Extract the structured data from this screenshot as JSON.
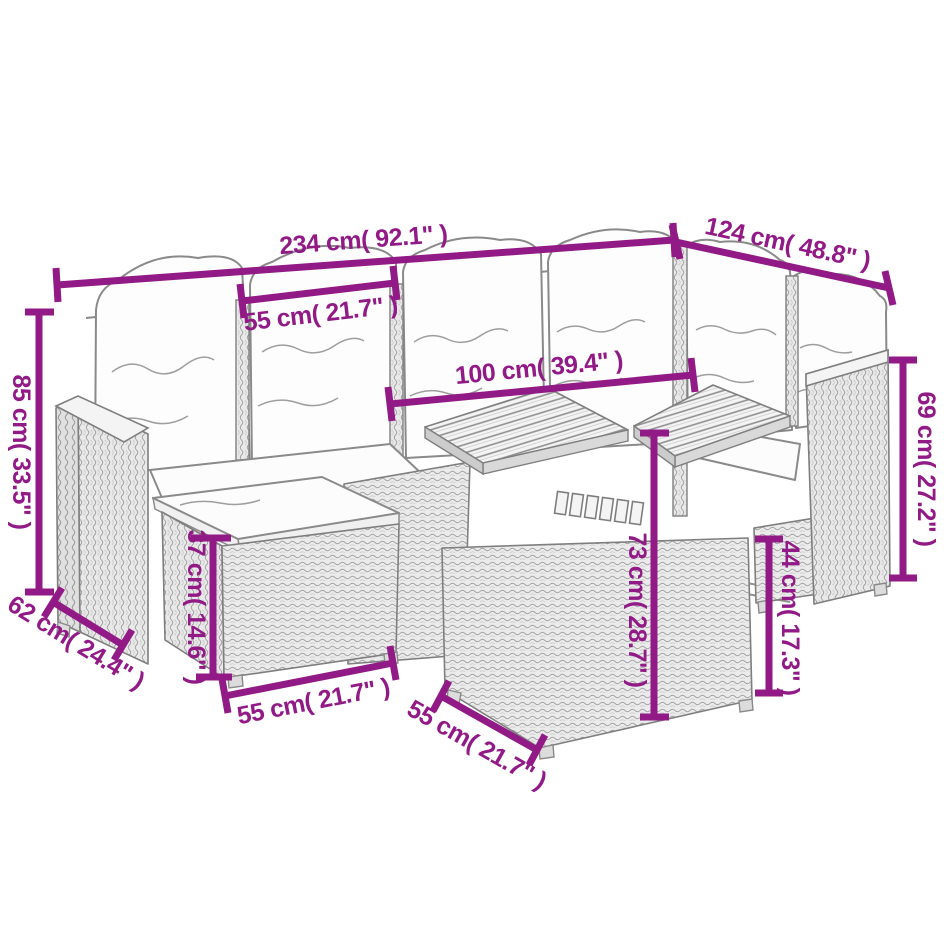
{
  "page": {
    "type": "product-dimension-diagram",
    "background": "#ffffff",
    "subject": "Poly rattan garden lounge set line drawing: corner sofa with back cushions, cushioned footstool, and two-panel wood-slat-top table"
  },
  "colors": {
    "dimension_annotation": "#921a86",
    "drawing_line": "#7f7f7f",
    "cushion_fill": "#fdfdfd"
  },
  "dimensions": [
    {
      "id": "total-width",
      "label": "234 cm( 92.1\" )",
      "value_cm": 234,
      "value_in": 92.1,
      "orientation": "horizontal-top"
    },
    {
      "id": "right-section-depth",
      "label": "124 cm( 48.8\" )",
      "value_cm": 124,
      "value_in": 48.8,
      "orientation": "diagonal-top-right"
    },
    {
      "id": "back-height",
      "label": "85 cm( 33.5\" )",
      "value_cm": 85,
      "value_in": 33.5,
      "orientation": "vertical-left"
    },
    {
      "id": "seat-section-width",
      "label": "55 cm( 21.7\" )",
      "value_cm": 55,
      "value_in": 21.7,
      "orientation": "horizontal-upper"
    },
    {
      "id": "table-length",
      "label": "100 cm( 39.4\" )",
      "value_cm": 100,
      "value_in": 39.4,
      "orientation": "horizontal-middle"
    },
    {
      "id": "armrest-height",
      "label": "69 cm( 27.2\" )",
      "value_cm": 69,
      "value_in": 27.2,
      "orientation": "vertical-right"
    },
    {
      "id": "footstool-height",
      "label": "37 cm( 14.6\" )",
      "value_cm": 37,
      "value_in": 14.6,
      "orientation": "vertical-footstool"
    },
    {
      "id": "table-height",
      "label": "73 cm( 28.7\" )",
      "value_cm": 73,
      "value_in": 28.7,
      "orientation": "vertical-table"
    },
    {
      "id": "table-base-height",
      "label": "44 cm( 17.3\" )",
      "value_cm": 44,
      "value_in": 17.3,
      "orientation": "vertical-table-base"
    },
    {
      "id": "left-section-depth",
      "label": "62 cm( 24.4\" )",
      "value_cm": 62,
      "value_in": 24.4,
      "orientation": "diagonal-bottom-left"
    },
    {
      "id": "footstool-width",
      "label": "55 cm( 21.7\" )",
      "value_cm": 55,
      "value_in": 21.7,
      "orientation": "horizontal-bottom"
    },
    {
      "id": "table-depth",
      "label": "55 cm( 21.7\" )",
      "value_cm": 55,
      "value_in": 21.7,
      "orientation": "diagonal-bottom-center"
    }
  ]
}
